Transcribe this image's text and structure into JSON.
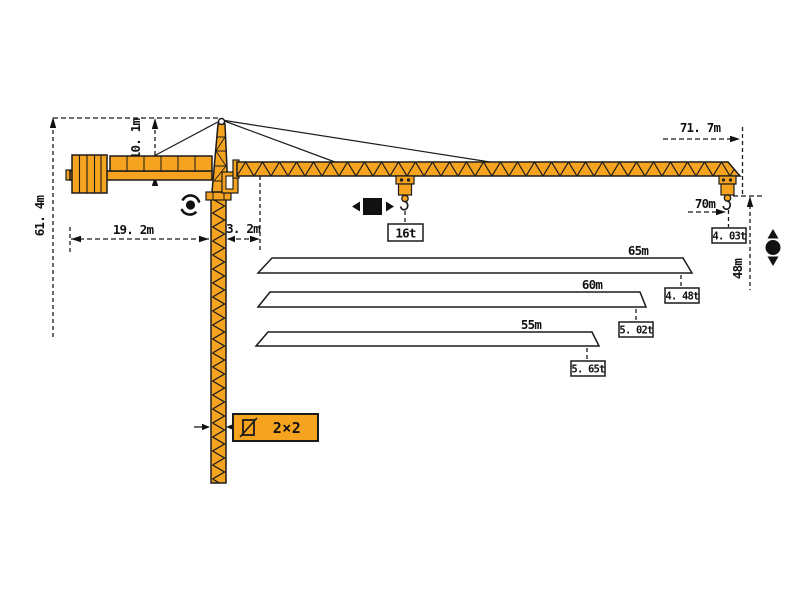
{
  "diagram": {
    "type": "tower-crane-working-range-diagram",
    "background": "#ffffff",
    "crane_color": "#f6a41f",
    "line_color": "#1b1b1b",
    "labels": {
      "total_height": "61. 4m",
      "tower_head_height": "10. 1m",
      "counter_jib_radius": "19. 2m",
      "jib_root_offset": "3. 2m",
      "overall_reach": "71. 7m",
      "main_jib_length": "70m",
      "hook_height": "48m",
      "max_load": "16t",
      "tip_load_70m": "4. 03t",
      "mast_section": "2×2"
    },
    "jib_variants": [
      {
        "length": "65m",
        "tip_load": "4. 48t"
      },
      {
        "length": "60m",
        "tip_load": "5. 02t"
      },
      {
        "length": "55m",
        "tip_load": "5. 65t"
      }
    ],
    "icons": {
      "slewing": "slewing-rotation-icon",
      "trolley": "trolley-travel-icon",
      "hoist": "hoist-up-down-icon",
      "section": "mast-cross-section-icon"
    }
  }
}
